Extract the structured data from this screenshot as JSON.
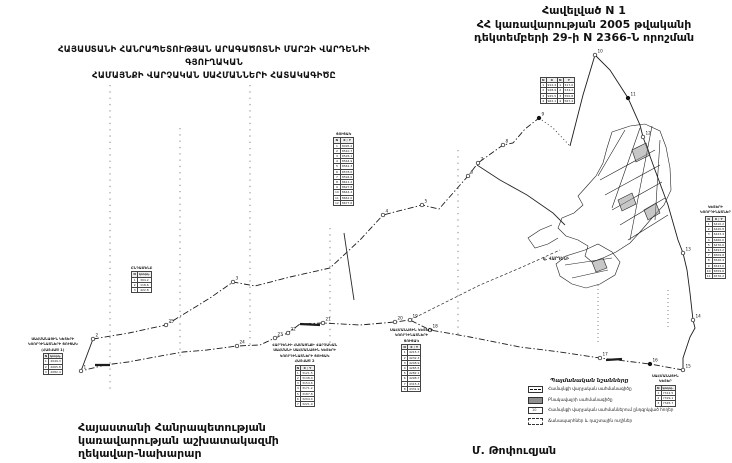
{
  "header": {
    "appendix": "Հավելված N 1",
    "decree_line1": "ՀՀ կառավարության 2005 թվականի",
    "decree_line2": "դեկտեմբերի 29-ի N 2366-Ն որոշման"
  },
  "title": {
    "line1": "ՀԱՅԱՍՏԱՆԻ ՀԱՆՐԱՊԵՏՈՒԹՅԱՆ ԱՐԱԳԱԾՈՏՆԻ ՄԱՐԶԻ ՎԱՐԴԵՆԻԻ ԳՅՈՒՂԱԿԱՆ",
    "line2": "ՀԱՄԱՅՆՔԻ ՎԱՐՉԱԿԱՆ ՍԱՀՄԱՆՆԵՐԻ ՀԱՏԱԿԱԳԻԾԸ"
  },
  "signature": {
    "line1": "Հայաստանի Հանրապետության",
    "line2": "կառավարության աշխատակազմի",
    "line3": "ղեկավար-նախարար",
    "name": "Մ. Թոփուզյան"
  },
  "map": {
    "village_label": "գ. ՎԱՐԴԵՆԻ",
    "colors": {
      "ink": "#1c1c1c",
      "parcel_fill": "#8f8f8f",
      "paper": "#ffffff"
    },
    "legend": {
      "title": "Պայմանական նշանները",
      "items": [
        {
          "symbol": "s-boundary",
          "label": "Համայնքի վարչական սահմանագիծը"
        },
        {
          "symbol": "s-settlement",
          "label": "Բնակավայրի սահմանագիծը"
        },
        {
          "symbol": "s-lands",
          "label": "Համայնքի վարչական սահմաններում ընդգրկված հողեր"
        },
        {
          "symbol": "s-roads",
          "label": "Ճանապարհներ և դաշտային ուղիներ"
        }
      ]
    },
    "boundary_points": [
      {
        "x": 81,
        "y": 371,
        "n": "1"
      },
      {
        "x": 93,
        "y": 339,
        "n": "2"
      },
      {
        "x": 233,
        "y": 282,
        "n": "3"
      },
      {
        "x": 383,
        "y": 215,
        "n": "4"
      },
      {
        "x": 422,
        "y": 205,
        "n": "5"
      },
      {
        "x": 468,
        "y": 176,
        "n": "6"
      },
      {
        "x": 478,
        "y": 163,
        "n": "7"
      },
      {
        "x": 503,
        "y": 145,
        "n": "8"
      },
      {
        "x": 539,
        "y": 118,
        "n": "9",
        "filled": true
      },
      {
        "x": 595,
        "y": 55,
        "n": "10"
      },
      {
        "x": 628,
        "y": 98,
        "n": "11",
        "filled": true
      },
      {
        "x": 643,
        "y": 137,
        "n": "12"
      },
      {
        "x": 683,
        "y": 253,
        "n": "13"
      },
      {
        "x": 693,
        "y": 320,
        "n": "14"
      },
      {
        "x": 683,
        "y": 370,
        "n": "15"
      },
      {
        "x": 650,
        "y": 364,
        "n": "16",
        "filled": true
      },
      {
        "x": 600,
        "y": 358,
        "n": "17"
      },
      {
        "x": 430,
        "y": 330,
        "n": "18"
      },
      {
        "x": 410,
        "y": 320,
        "n": "19"
      },
      {
        "x": 395,
        "y": 322,
        "n": "20"
      },
      {
        "x": 323,
        "y": 323,
        "n": "21"
      },
      {
        "x": 288,
        "y": 333,
        "n": "22"
      },
      {
        "x": 275,
        "y": 338,
        "n": "23"
      },
      {
        "x": 237,
        "y": 346,
        "n": "24"
      },
      {
        "x": 166,
        "y": 325,
        "n": "25"
      }
    ],
    "stamps": [
      {
        "key": "stamp-mid-left",
        "x": 131,
        "y": 266,
        "caption": [
          "ԸՆԴԱՄԵՆԸ"
        ],
        "header": [
          "N",
          "կոորդ."
        ],
        "rows": [
          [
            "1",
            "304.2"
          ],
          [
            "2",
            "118.6"
          ],
          [
            "3",
            "422.8"
          ]
        ]
      },
      {
        "key": "stamp-tall-center",
        "x": 333,
        "y": 132,
        "caption": [
          "ՑՈՒՑԱԿ"
        ],
        "header": [
          "N",
          "X ; Y"
        ],
        "rows": [
          [
            "1",
            "8495.2"
          ],
          [
            "2",
            "8510.7"
          ],
          [
            "3",
            "8526.1"
          ],
          [
            "4",
            "8544.9"
          ],
          [
            "5",
            "8561.3"
          ],
          [
            "6",
            "8578.0"
          ],
          [
            "7",
            "8594.6"
          ],
          [
            "8",
            "8611.2"
          ],
          [
            "9",
            "8627.8"
          ],
          [
            "10",
            "8644.4"
          ],
          [
            "11",
            "8661.0"
          ],
          [
            "12",
            "8677.6"
          ]
        ]
      },
      {
        "key": "stamp-left-bottom",
        "x": 28,
        "y": 337,
        "caption": [
          "ՍԱՀՄԱՆԱՅԻՆ ԿԵՏԵՐԻ",
          "ԿՈՈՐԴԻՆԱՏՆԵՐԻ ՑՈՒՑԱԿ",
          "(ՀԱՏՎԱԾ 1)"
        ],
        "header": [
          "N",
          "կոորդ."
        ],
        "rows": [
          [
            "1",
            "2049.3"
          ],
          [
            "2",
            "2065.8"
          ],
          [
            "3",
            "2082.4"
          ]
        ]
      },
      {
        "key": "stamp-bottom-center-1",
        "x": 272,
        "y": 343,
        "caption": [
          "ՎԱՐԴԵՆԻԻ ՀԱՄԱՅՆՔԻ ՎԱՐՉԱԿԱՆ",
          "ՍԱՀՄԱՆԻ ՍԱՀՄԱՆԱՅԻՆ ԿԵՏԵՐԻ",
          "ԿՈՈՐԴԻՆԱՏՆԵՐԻ ՑՈՒՑԱԿ",
          "ՀԱՏՎԱԾ 2"
        ],
        "header": [
          "N",
          "X ; Y"
        ],
        "rows": [
          [
            "1",
            "3121.5"
          ],
          [
            "2",
            "3138.0"
          ],
          [
            "3",
            "3154.6"
          ],
          [
            "4",
            "3171.2"
          ],
          [
            "5",
            "3187.8"
          ],
          [
            "6",
            "3204.4"
          ],
          [
            "7",
            "3221.0"
          ]
        ]
      },
      {
        "key": "stamp-bottom-center-2",
        "x": 390,
        "y": 328,
        "caption": [
          "ՍԱՀՄԱՆԱՅԻՆ ԿԵՏԵՐԻ",
          "ԿՈՈՐԴԻՆԱՏՆԵՐԻ",
          "ՑՈՒՑԱԿ"
        ],
        "header": [
          "N",
          "X ; Y"
        ],
        "rows": [
          [
            "1",
            "4215.7"
          ],
          [
            "2",
            "4232.3"
          ],
          [
            "3",
            "4248.9"
          ],
          [
            "4",
            "4265.5"
          ],
          [
            "5",
            "4282.1"
          ],
          [
            "6",
            "4298.7"
          ],
          [
            "7",
            "4315.3"
          ],
          [
            "8",
            "4331.9"
          ]
        ]
      },
      {
        "key": "stamp-top-right-a",
        "x": 540,
        "y": 77,
        "caption": [],
        "header": [
          "N",
          "X"
        ],
        "rows": [
          [
            "1",
            "912.4"
          ],
          [
            "2",
            "928.9"
          ],
          [
            "3",
            "945.5"
          ],
          [
            "4",
            "962.1"
          ]
        ]
      },
      {
        "key": "stamp-top-right-b",
        "x": 557,
        "y": 77,
        "caption": [],
        "header": [
          "N",
          "Y"
        ],
        "rows": [
          [
            "1",
            "517.6"
          ],
          [
            "2",
            "534.2"
          ],
          [
            "3",
            "550.8"
          ],
          [
            "4",
            "567.4"
          ]
        ]
      },
      {
        "key": "stamp-right-edge",
        "x": 700,
        "y": 205,
        "caption": [
          "ԿԵՏԵՐԻ",
          "ԿՈՈՐԴԻՆԱՏՆԵՐ"
        ],
        "header": [
          "N",
          "X ; Y"
        ],
        "rows": [
          [
            "1",
            "6410.2"
          ],
          [
            "2",
            "6426.8"
          ],
          [
            "3",
            "6443.4"
          ],
          [
            "4",
            "6460.0"
          ],
          [
            "5",
            "6476.6"
          ],
          [
            "6",
            "6493.2"
          ],
          [
            "7",
            "6509.8"
          ],
          [
            "8",
            "6526.4"
          ],
          [
            "9",
            "6543.0"
          ],
          [
            "10",
            "6559.6"
          ],
          [
            "11",
            "6576.2"
          ]
        ]
      },
      {
        "key": "stamp-bottom-right",
        "x": 652,
        "y": 374,
        "caption": [
          "ՍԱՀՄԱՆԱՅԻՆ",
          "ԿԵՏԵՐ"
        ],
        "header": [
          "N",
          "կոորդ."
        ],
        "rows": [
          [
            "1",
            "7312.5"
          ],
          [
            "2",
            "7329.1"
          ],
          [
            "3",
            "7345.7"
          ]
        ]
      }
    ]
  }
}
